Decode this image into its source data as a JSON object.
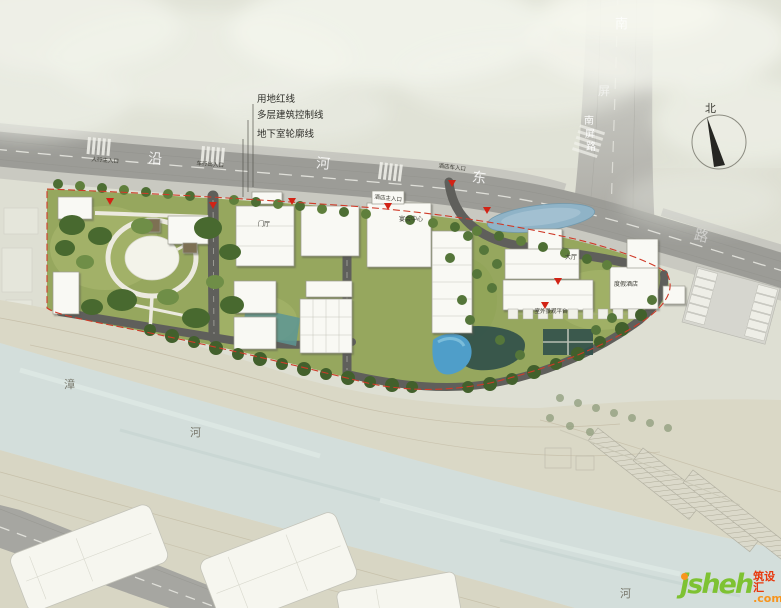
{
  "legend": {
    "items": [
      {
        "label": "用地红线"
      },
      {
        "label": "多层建筑控制线"
      },
      {
        "label": "地下室轮廓线"
      }
    ]
  },
  "compass": {
    "north": "北"
  },
  "roads": {
    "riverside": {
      "name": "沿河东路",
      "c1": "沿",
      "c2": "河",
      "c3": "东",
      "c4": "路"
    },
    "nanping": {
      "name": "南屏路",
      "faded_c1": "南",
      "faded_c2": "屏",
      "c1": "南",
      "c2": "屏",
      "c3": "路"
    }
  },
  "entrances": {
    "pedestrian_main": "人行主入口",
    "vehicle_access": "车行出入口",
    "hotel_main": "酒店主入口",
    "hotel_vehicle": "酒店车入口"
  },
  "places": {
    "entry_hall": "门厅",
    "banquet_center": "宴会中心",
    "hotel_lobby": "大厅",
    "resort_hotel": "度假酒店",
    "outdoor_terrace": "室外景观平台"
  },
  "river": {
    "name": "漳河",
    "left_c1": "漳",
    "left_c2": "河",
    "right_c": "河"
  },
  "logo": {
    "brand": "jsheh",
    "tld": ".com",
    "cn": "筑设汇"
  },
  "colors": {
    "boundary_red": "#cf3a28",
    "site_green": "#96a75e",
    "pond_blue": "#8fb3c7",
    "pool_blue": "#4f9ec9",
    "river_blue": "#d3dedb",
    "logo_green": "#7ec232",
    "logo_orange": "#f7941d"
  }
}
